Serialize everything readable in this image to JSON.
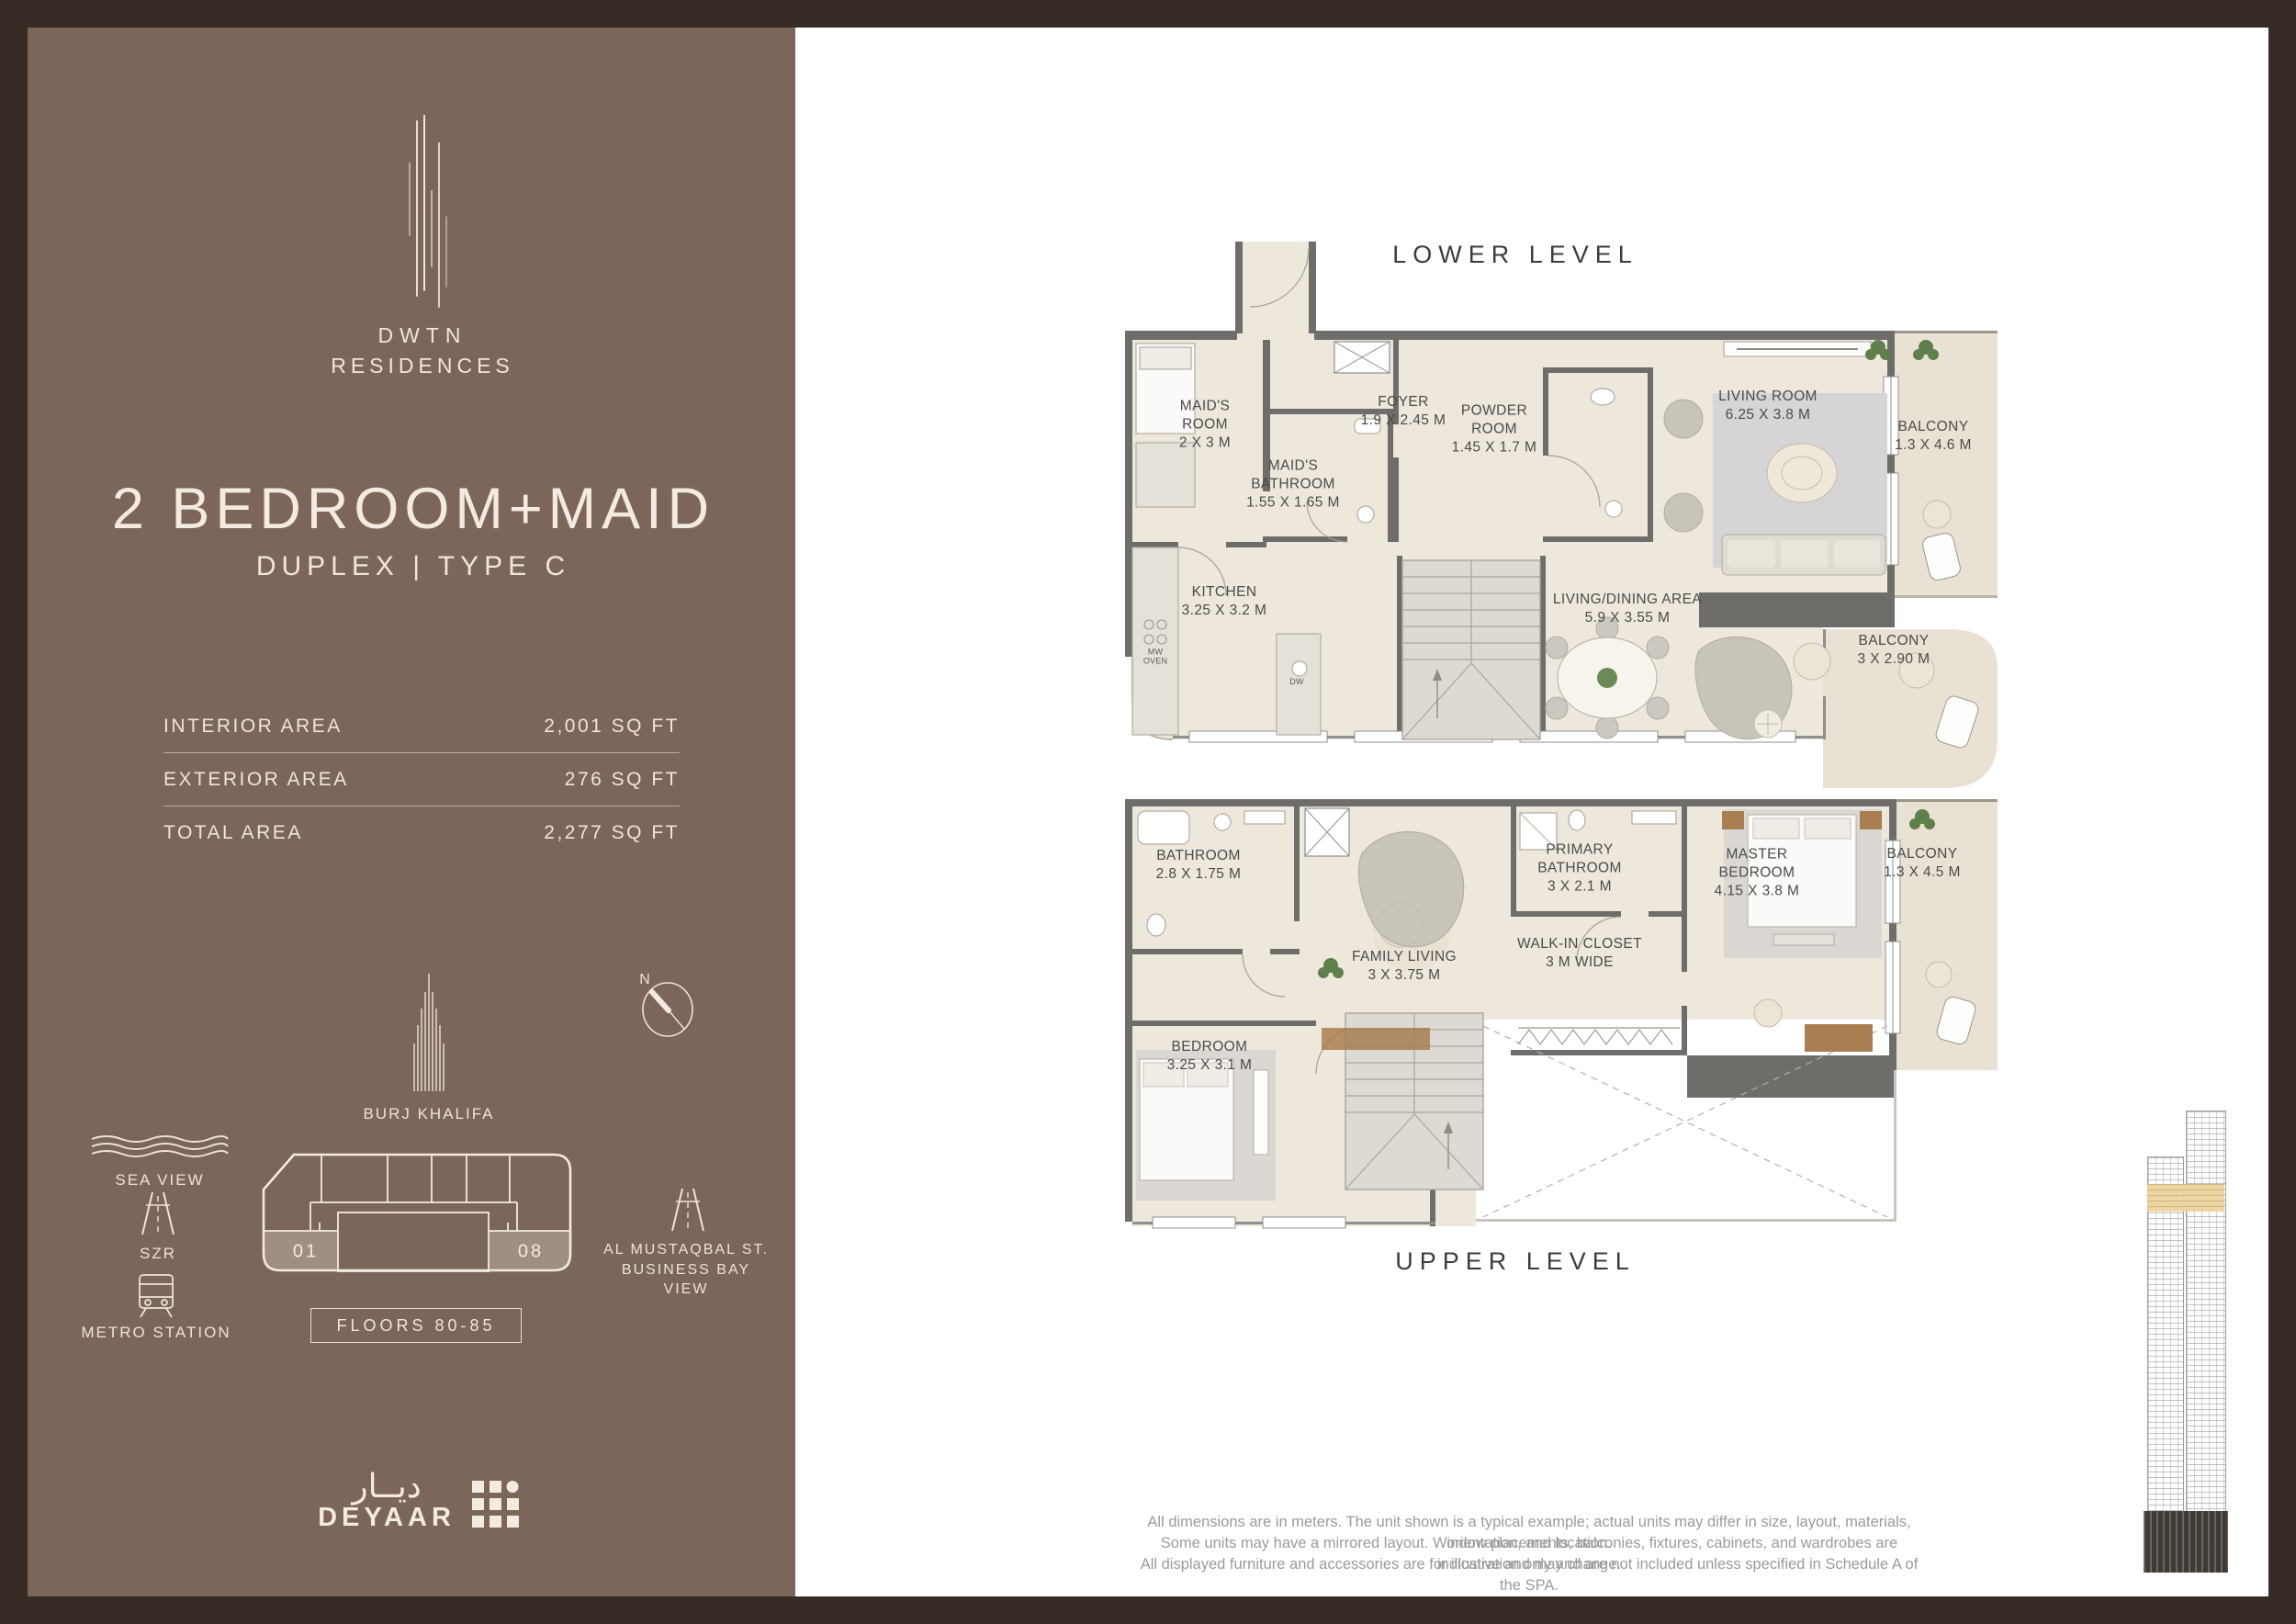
{
  "sidebar": {
    "brand_line1": "DWTN",
    "brand_line2": "RESIDENCES",
    "title": "2 BEDROOM+MAID",
    "subtitle": "DUPLEX | TYPE C",
    "area_table": {
      "rows": [
        {
          "label": "INTERIOR AREA",
          "value": "2,001 SQ FT"
        },
        {
          "label": "EXTERIOR AREA",
          "value": "276 SQ FT"
        },
        {
          "label": "TOTAL AREA",
          "value": "2,277 SQ FT"
        }
      ]
    },
    "landmark_label": "BURJ KHALIFA",
    "compass_label": "N",
    "sea_view_label": "SEA VIEW",
    "szr_label": "SZR",
    "metro_label": "METRO STATION",
    "street_label": "AL MUSTAQBAL ST.\nBUSINESS BAY\nVIEW",
    "keyplan": {
      "unit_left": "01",
      "unit_right": "08",
      "floors_label": "FLOORS 80-85"
    },
    "logo": {
      "arabic": "ديــار",
      "latin": "DEYAAR"
    }
  },
  "lower": {
    "title": "LOWER LEVEL",
    "rooms": [
      {
        "label": "MAID'S\nROOM\n2 X 3 M"
      },
      {
        "label": "MAID'S\nBATHROOM\n1.55 X 1.65 M"
      },
      {
        "label": "FOYER\n1.9 X 2.45 M"
      },
      {
        "label": "POWDER\nROOM\n1.45 X 1.7 M"
      },
      {
        "label": "KITCHEN\n3.25 X 3.2 M"
      },
      {
        "label": "LIVING ROOM\n6.25 X 3.8 M"
      },
      {
        "label": "BALCONY\n1.3 X 4.6 M"
      },
      {
        "label": "LIVING/DINING AREA\n5.9 X 3.55 M"
      },
      {
        "label": "BALCONY\n3 X 2.90 M"
      }
    ],
    "appliances": [
      {
        "label": "MW\nOVEN"
      },
      {
        "label": "DW"
      }
    ]
  },
  "upper": {
    "title": "UPPER LEVEL",
    "rooms": [
      {
        "label": "BATHROOM\n2.8 X 1.75 M"
      },
      {
        "label": "FAMILY LIVING\n3 X 3.75 M"
      },
      {
        "label": "PRIMARY\nBATHROOM\n3 X 2.1 M"
      },
      {
        "label": "MASTER\nBEDROOM\n4.15 X 3.8 M"
      },
      {
        "label": "BALCONY\n1.3 X 4.5 M"
      },
      {
        "label": "WALK-IN CLOSET\n3 M WIDE"
      },
      {
        "label": "BEDROOM\n3.25 X 3.1 M"
      }
    ]
  },
  "disclaimer": {
    "line1": "All dimensions are in meters. The unit shown is a typical example; actual units may differ in size, layout, materials, orientation, and location.",
    "line2": "Some units may have a mirrored layout. Window placements, balconies, fixtures, cabinets, and wardrobes are indicative and may change.",
    "line3": "All displayed furniture and accessories are for illustration only and are not included unless specified in Schedule A of the SPA."
  },
  "colors": {
    "frame": "#372b25",
    "sidebar": "#7c6659",
    "wall": "#6f6d6a",
    "floor": "#ede7dc",
    "balcony_floor": "#e9e2d4",
    "highlight_band": "#ecd39a"
  }
}
